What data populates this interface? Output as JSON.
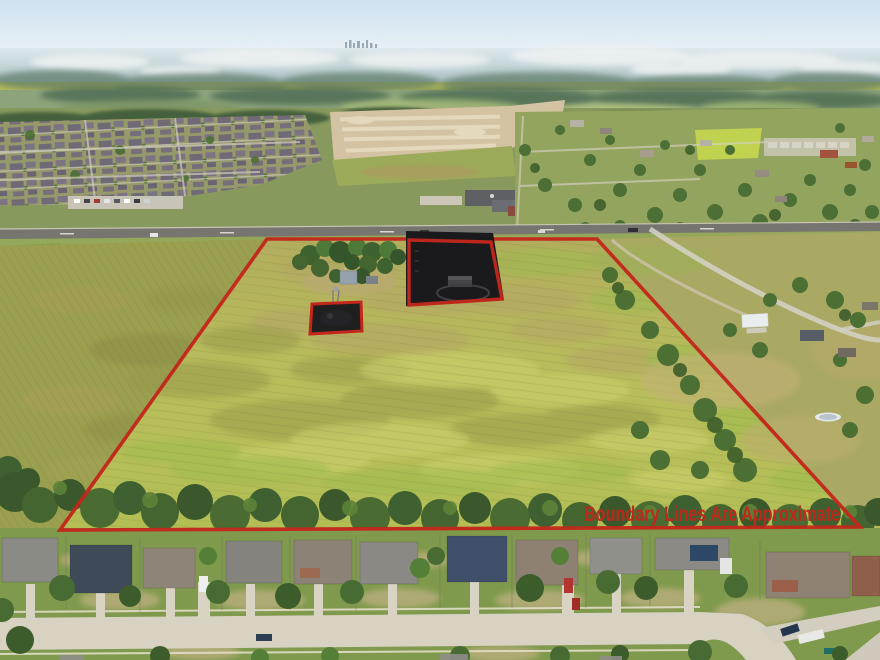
{
  "scene": {
    "description": "Aerial drone photograph of a large yellow-green grass acreage outlined with a red property boundary; a highway borders the top, rural homes sit to the right, a dense rooftop subdivision and graded dirt construction site lie beyond the road, suburban houses line the bottom street, and a hazy horizon with a distant city skyline tops the frame. Two areas inside the parcel are blacked out with red-outlined redaction boxes.",
    "watermark_text": "Boundary Lines Are Approximate"
  },
  "colors": {
    "boundary_red": "#c3261b",
    "redaction_black": "#1a1a1d",
    "field_yellow_green": "#b6bc59",
    "sky_blue": "#d9e8f3",
    "tree_green": "#44652f",
    "street_concrete": "#d8d2c2"
  }
}
